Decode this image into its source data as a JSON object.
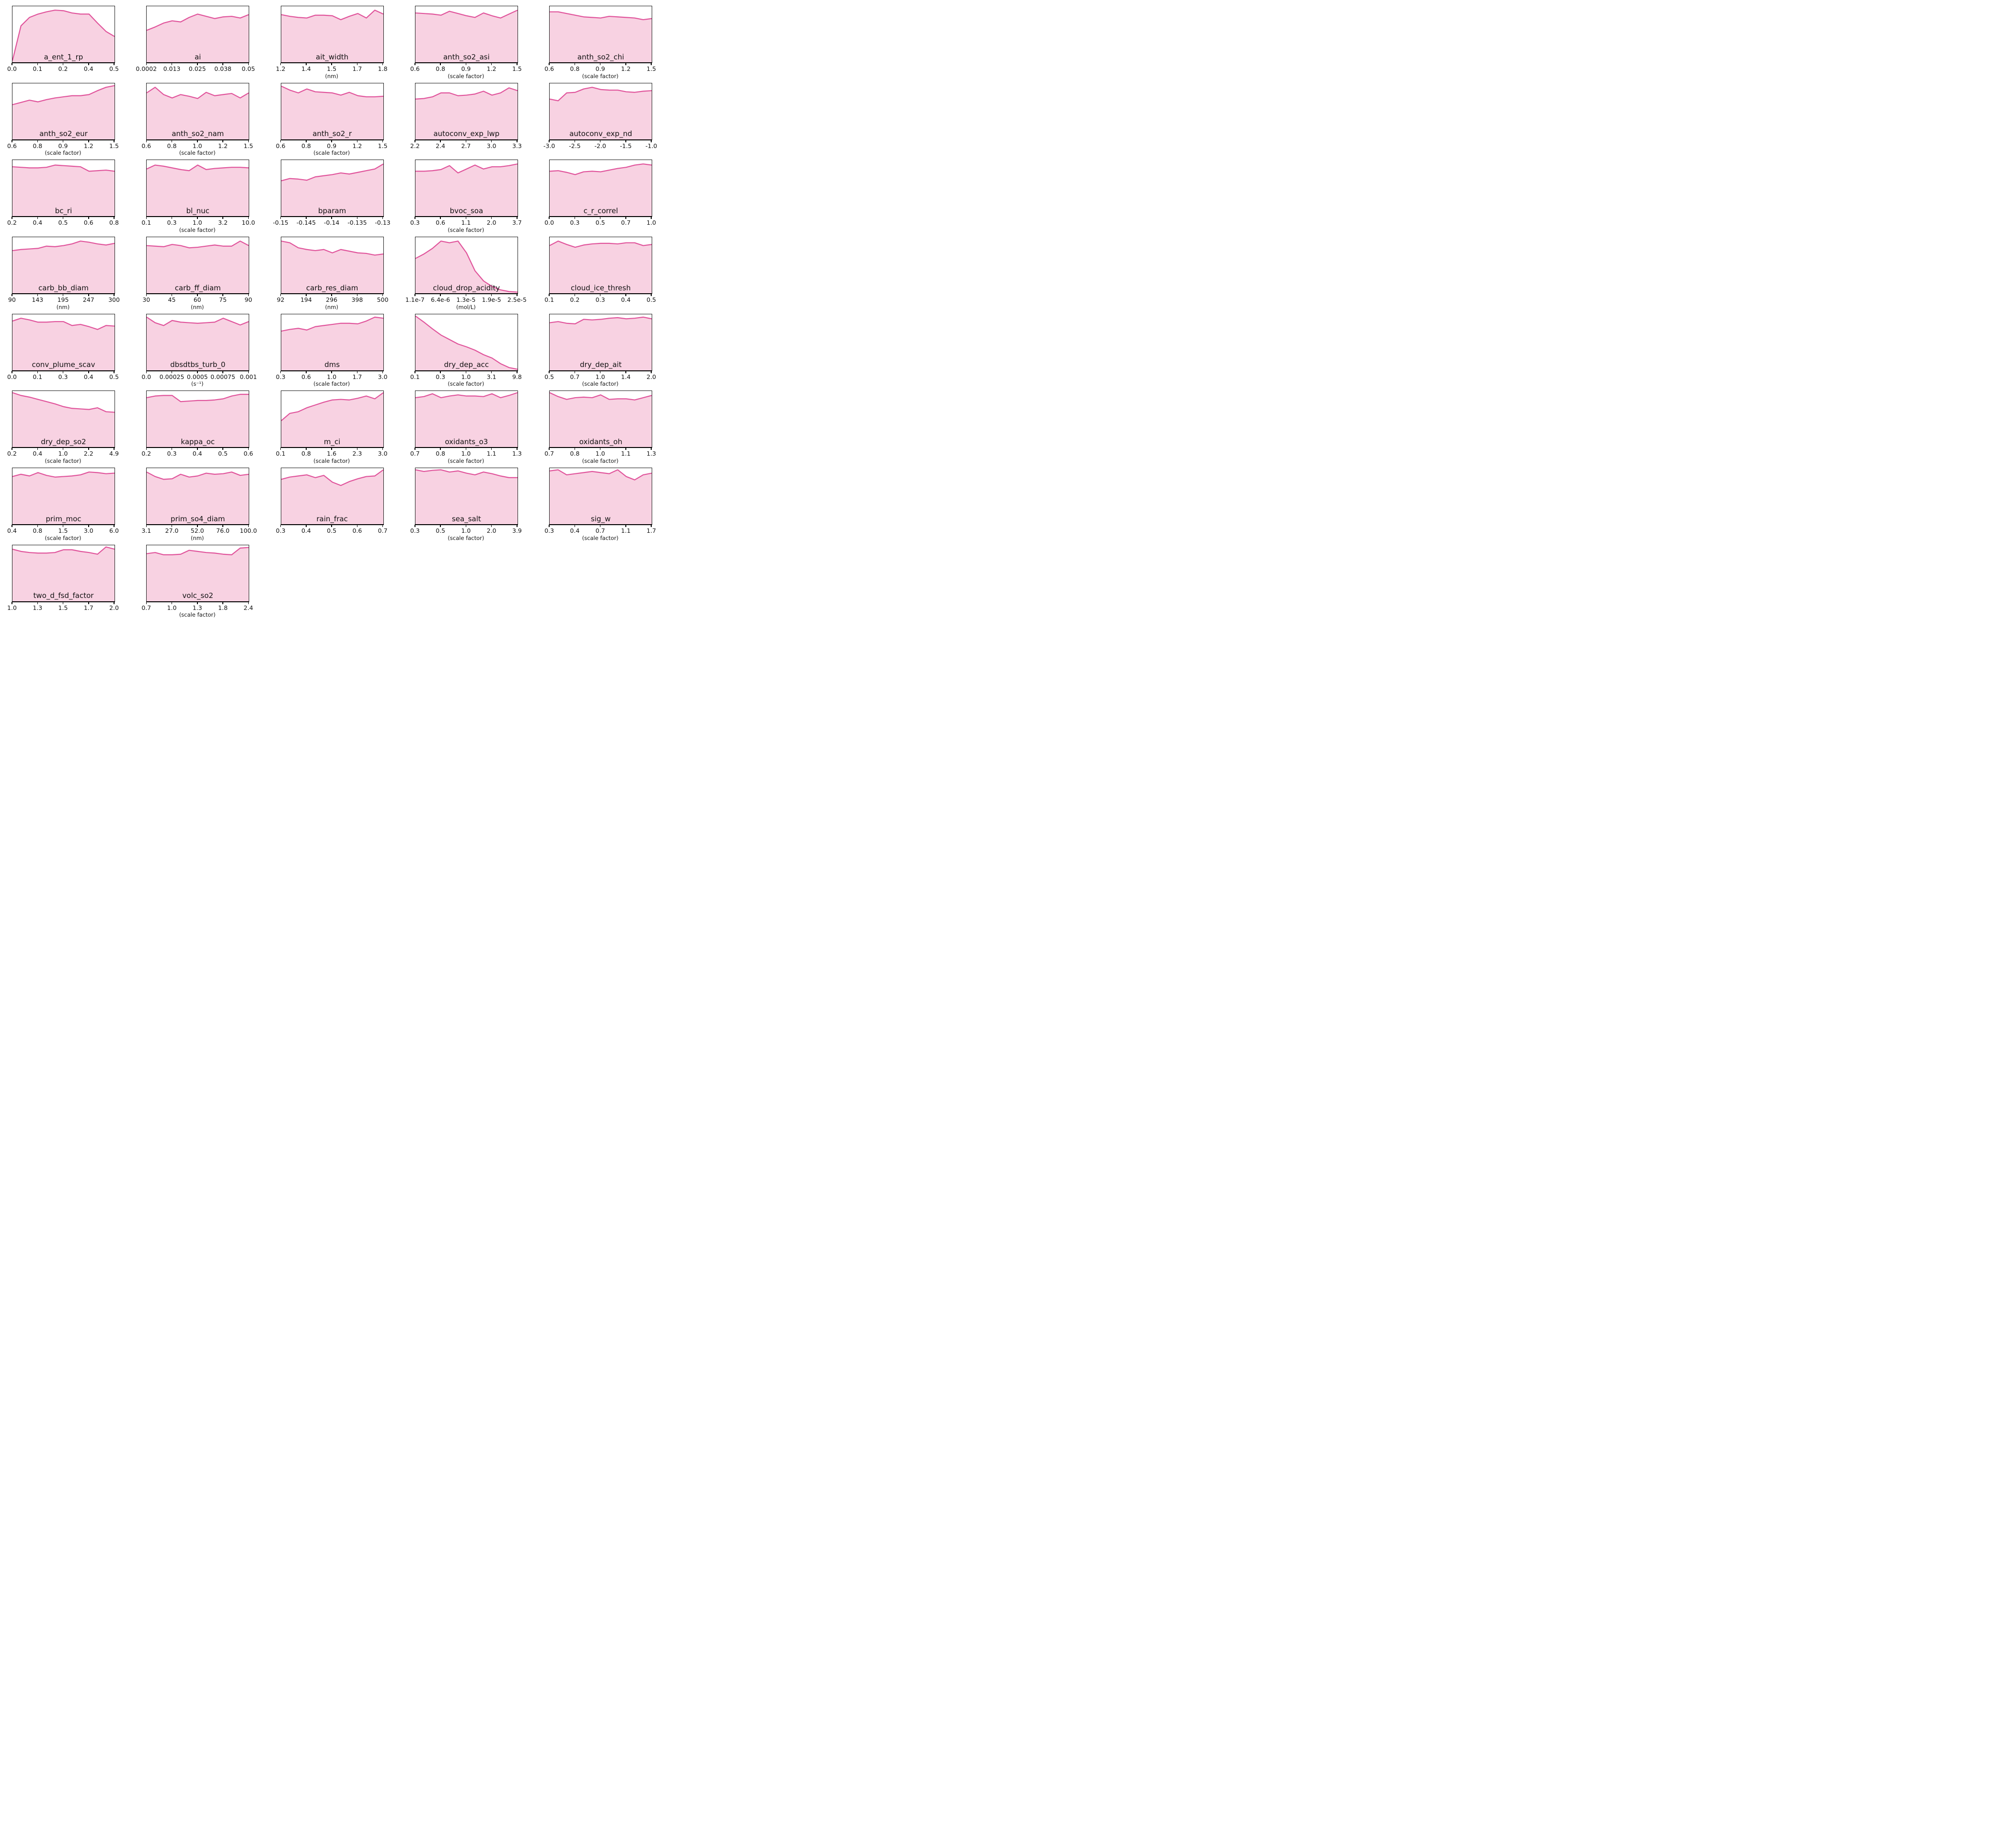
{
  "figure": {
    "background": "#ffffff",
    "line_color": "#e0549b",
    "fill_color": "#f8d2e2",
    "spine_color": "#1a1a1a",
    "columns": 5,
    "rows": 8
  },
  "chart_data": {
    "type": "area",
    "title": "",
    "ylabel": "",
    "grid": "off",
    "legend": "none",
    "y_values_note": "normalized marginal-density curve heights (0 = axis bottom, 1 = axes top), 13 evenly spaced samples across each x-range",
    "x_tick_positions_percent": [
      0,
      25,
      50,
      75,
      100
    ],
    "charts": [
      {
        "name": "a_ent_1_rp",
        "unit": "",
        "x_ticks": [
          "0.0",
          "0.1",
          "0.2",
          "0.4",
          "0.5"
        ],
        "y_norm": [
          0.03,
          0.65,
          0.8,
          0.86,
          0.9,
          0.93,
          0.92,
          0.88,
          0.86,
          0.86,
          0.7,
          0.55,
          0.46
        ]
      },
      {
        "name": "ai",
        "unit": "",
        "x_ticks": [
          "0.0002",
          "0.013",
          "0.025",
          "0.038",
          "0.05"
        ],
        "y_norm": [
          0.57,
          0.63,
          0.7,
          0.74,
          0.72,
          0.8,
          0.86,
          0.82,
          0.78,
          0.81,
          0.82,
          0.79,
          0.85
        ]
      },
      {
        "name": "ait_width",
        "unit": "(nm)",
        "x_ticks": [
          "1.2",
          "1.4",
          "1.5",
          "1.7",
          "1.8"
        ],
        "y_norm": [
          0.85,
          0.82,
          0.8,
          0.79,
          0.84,
          0.84,
          0.83,
          0.76,
          0.82,
          0.87,
          0.79,
          0.93,
          0.86
        ]
      },
      {
        "name": "anth_so2_asi",
        "unit": "(scale factor)",
        "x_ticks": [
          "0.6",
          "0.8",
          "0.9",
          "1.2",
          "1.5"
        ],
        "y_norm": [
          0.88,
          0.87,
          0.86,
          0.84,
          0.91,
          0.87,
          0.83,
          0.8,
          0.88,
          0.83,
          0.79,
          0.86,
          0.93
        ]
      },
      {
        "name": "anth_so2_chi",
        "unit": "(scale factor)",
        "x_ticks": [
          "0.6",
          "0.8",
          "0.9",
          "1.2",
          "1.5"
        ],
        "y_norm": [
          0.9,
          0.9,
          0.87,
          0.84,
          0.81,
          0.8,
          0.79,
          0.82,
          0.81,
          0.8,
          0.79,
          0.76,
          0.78
        ]
      },
      {
        "name": "anth_so2_eur",
        "unit": "(scale factor)",
        "x_ticks": [
          "0.6",
          "0.8",
          "0.9",
          "1.2",
          "1.5"
        ],
        "y_norm": [
          0.62,
          0.66,
          0.7,
          0.67,
          0.71,
          0.74,
          0.76,
          0.78,
          0.78,
          0.8,
          0.87,
          0.93,
          0.96
        ]
      },
      {
        "name": "anth_so2_nam",
        "unit": "(scale factor)",
        "x_ticks": [
          "0.6",
          "0.8",
          "1.0",
          "1.2",
          "1.5"
        ],
        "y_norm": [
          0.83,
          0.93,
          0.8,
          0.74,
          0.8,
          0.77,
          0.73,
          0.84,
          0.78,
          0.8,
          0.82,
          0.74,
          0.83
        ]
      },
      {
        "name": "anth_so2_r",
        "unit": "(scale factor)",
        "x_ticks": [
          "0.6",
          "0.8",
          "0.9",
          "1.2",
          "1.5"
        ],
        "y_norm": [
          0.95,
          0.88,
          0.83,
          0.9,
          0.85,
          0.84,
          0.83,
          0.79,
          0.84,
          0.78,
          0.76,
          0.76,
          0.77
        ]
      },
      {
        "name": "autoconv_exp_lwp",
        "unit": "",
        "x_ticks": [
          "2.2",
          "2.4",
          "2.7",
          "3.0",
          "3.3"
        ],
        "y_norm": [
          0.72,
          0.73,
          0.76,
          0.83,
          0.83,
          0.78,
          0.79,
          0.81,
          0.86,
          0.79,
          0.83,
          0.92,
          0.87
        ]
      },
      {
        "name": "autoconv_exp_nd",
        "unit": "",
        "x_ticks": [
          "-3.0",
          "-2.5",
          "-2.0",
          "-1.5",
          "-1.0"
        ],
        "y_norm": [
          0.72,
          0.69,
          0.83,
          0.84,
          0.9,
          0.93,
          0.89,
          0.88,
          0.88,
          0.85,
          0.84,
          0.86,
          0.87
        ]
      },
      {
        "name": "bc_ri",
        "unit": "",
        "x_ticks": [
          "0.2",
          "0.4",
          "0.5",
          "0.6",
          "0.8"
        ],
        "y_norm": [
          0.88,
          0.87,
          0.86,
          0.86,
          0.87,
          0.91,
          0.9,
          0.89,
          0.88,
          0.8,
          0.81,
          0.82,
          0.8
        ]
      },
      {
        "name": "bl_nuc",
        "unit": "(scale factor)",
        "x_ticks": [
          "0.1",
          "0.3",
          "1.0",
          "3.2",
          "10.0"
        ],
        "y_norm": [
          0.84,
          0.91,
          0.89,
          0.86,
          0.83,
          0.81,
          0.91,
          0.83,
          0.85,
          0.86,
          0.87,
          0.87,
          0.86
        ]
      },
      {
        "name": "bparam",
        "unit": "",
        "x_ticks": [
          "-0.15",
          "-0.145",
          "-0.14",
          "-0.135",
          "-0.13"
        ],
        "y_norm": [
          0.63,
          0.67,
          0.66,
          0.64,
          0.7,
          0.72,
          0.74,
          0.77,
          0.75,
          0.78,
          0.81,
          0.84,
          0.93
        ]
      },
      {
        "name": "bvoc_soa",
        "unit": "(scale factor)",
        "x_ticks": [
          "0.3",
          "0.6",
          "1.1",
          "2.0",
          "3.7"
        ],
        "y_norm": [
          0.8,
          0.8,
          0.81,
          0.83,
          0.9,
          0.77,
          0.84,
          0.91,
          0.84,
          0.88,
          0.88,
          0.9,
          0.93
        ]
      },
      {
        "name": "c_r_correl",
        "unit": "",
        "x_ticks": [
          "0.0",
          "0.3",
          "0.5",
          "0.7",
          "1.0"
        ],
        "y_norm": [
          0.8,
          0.81,
          0.78,
          0.74,
          0.79,
          0.8,
          0.79,
          0.82,
          0.85,
          0.87,
          0.91,
          0.93,
          0.91
        ]
      },
      {
        "name": "carb_bb_diam",
        "unit": "(nm)",
        "x_ticks": [
          "90",
          "143",
          "195",
          "247",
          "300"
        ],
        "y_norm": [
          0.76,
          0.78,
          0.79,
          0.8,
          0.84,
          0.83,
          0.85,
          0.88,
          0.93,
          0.91,
          0.88,
          0.86,
          0.89
        ]
      },
      {
        "name": "carb_ff_diam",
        "unit": "(nm)",
        "x_ticks": [
          "30",
          "45",
          "60",
          "75",
          "90"
        ],
        "y_norm": [
          0.85,
          0.84,
          0.83,
          0.87,
          0.85,
          0.81,
          0.82,
          0.84,
          0.86,
          0.84,
          0.84,
          0.93,
          0.85
        ]
      },
      {
        "name": "carb_res_diam",
        "unit": "(nm)",
        "x_ticks": [
          "92",
          "194",
          "296",
          "398",
          "500"
        ],
        "y_norm": [
          0.93,
          0.9,
          0.81,
          0.78,
          0.76,
          0.78,
          0.72,
          0.78,
          0.75,
          0.72,
          0.71,
          0.68,
          0.7
        ]
      },
      {
        "name": "cloud_drop_acidity",
        "unit": "(mol/L)",
        "x_ticks": [
          "1.1e-7",
          "6.4e-6",
          "1.3e-5",
          "1.9e-5",
          "2.5e-5"
        ],
        "y_norm": [
          0.62,
          0.7,
          0.8,
          0.93,
          0.9,
          0.93,
          0.72,
          0.4,
          0.22,
          0.12,
          0.06,
          0.03,
          0.02
        ]
      },
      {
        "name": "cloud_ice_thresh",
        "unit": "",
        "x_ticks": [
          "0.1",
          "0.2",
          "0.3",
          "0.4",
          "0.5"
        ],
        "y_norm": [
          0.85,
          0.93,
          0.87,
          0.82,
          0.86,
          0.88,
          0.89,
          0.89,
          0.88,
          0.9,
          0.9,
          0.85,
          0.87
        ]
      },
      {
        "name": "conv_plume_scav",
        "unit": "",
        "x_ticks": [
          "0.0",
          "0.1",
          "0.3",
          "0.4",
          "0.5"
        ],
        "y_norm": [
          0.88,
          0.93,
          0.9,
          0.86,
          0.86,
          0.87,
          0.87,
          0.8,
          0.82,
          0.78,
          0.73,
          0.8,
          0.79
        ]
      },
      {
        "name": "dbsdtbs_turb_0",
        "unit": "(s⁻¹)",
        "x_ticks": [
          "0.0",
          "0.00025",
          "0.0005",
          "0.00075",
          "0.001"
        ],
        "y_norm": [
          0.95,
          0.85,
          0.8,
          0.89,
          0.86,
          0.85,
          0.84,
          0.85,
          0.86,
          0.93,
          0.87,
          0.81,
          0.87
        ]
      },
      {
        "name": "dms",
        "unit": "(scale factor)",
        "x_ticks": [
          "0.3",
          "0.6",
          "1.0",
          "1.7",
          "3.0"
        ],
        "y_norm": [
          0.7,
          0.73,
          0.75,
          0.72,
          0.78,
          0.8,
          0.82,
          0.84,
          0.84,
          0.83,
          0.88,
          0.95,
          0.93
        ]
      },
      {
        "name": "dry_dep_acc",
        "unit": "(scale factor)",
        "x_ticks": [
          "0.1",
          "0.3",
          "1.0",
          "3.1",
          "9.8"
        ],
        "y_norm": [
          0.97,
          0.86,
          0.74,
          0.63,
          0.55,
          0.47,
          0.42,
          0.36,
          0.28,
          0.22,
          0.12,
          0.05,
          0.02
        ]
      },
      {
        "name": "dry_dep_ait",
        "unit": "(scale factor)",
        "x_ticks": [
          "0.5",
          "0.7",
          "1.0",
          "1.4",
          "2.0"
        ],
        "y_norm": [
          0.85,
          0.87,
          0.84,
          0.83,
          0.91,
          0.9,
          0.91,
          0.93,
          0.94,
          0.92,
          0.93,
          0.95,
          0.92
        ]
      },
      {
        "name": "dry_dep_so2",
        "unit": "(scale factor)",
        "x_ticks": [
          "0.2",
          "0.4",
          "1.0",
          "2.2",
          "4.9"
        ],
        "y_norm": [
          0.97,
          0.92,
          0.89,
          0.85,
          0.81,
          0.77,
          0.72,
          0.69,
          0.68,
          0.67,
          0.7,
          0.63,
          0.62
        ]
      },
      {
        "name": "kappa_oc",
        "unit": "",
        "x_ticks": [
          "0.2",
          "0.3",
          "0.4",
          "0.5",
          "0.6"
        ],
        "y_norm": [
          0.88,
          0.91,
          0.92,
          0.92,
          0.81,
          0.82,
          0.83,
          0.83,
          0.84,
          0.86,
          0.91,
          0.94,
          0.94
        ]
      },
      {
        "name": "m_ci",
        "unit": "(scale factor)",
        "x_ticks": [
          "0.1",
          "0.8",
          "1.6",
          "2.3",
          "3.0"
        ],
        "y_norm": [
          0.47,
          0.6,
          0.63,
          0.7,
          0.75,
          0.8,
          0.84,
          0.85,
          0.84,
          0.87,
          0.91,
          0.86,
          0.97
        ]
      },
      {
        "name": "oxidants_o3",
        "unit": "(scale factor)",
        "x_ticks": [
          "0.7",
          "0.8",
          "1.0",
          "1.1",
          "1.3"
        ],
        "y_norm": [
          0.88,
          0.9,
          0.95,
          0.88,
          0.91,
          0.93,
          0.91,
          0.91,
          0.9,
          0.95,
          0.88,
          0.92,
          0.97
        ]
      },
      {
        "name": "oxidants_oh",
        "unit": "(scale factor)",
        "x_ticks": [
          "0.7",
          "0.8",
          "1.0",
          "1.1",
          "1.3"
        ],
        "y_norm": [
          0.97,
          0.9,
          0.85,
          0.88,
          0.89,
          0.88,
          0.93,
          0.85,
          0.86,
          0.86,
          0.84,
          0.88,
          0.92
        ]
      },
      {
        "name": "prim_moc",
        "unit": "(scale factor)",
        "x_ticks": [
          "0.4",
          "0.8",
          "1.5",
          "3.0",
          "6.0"
        ],
        "y_norm": [
          0.85,
          0.89,
          0.86,
          0.92,
          0.87,
          0.84,
          0.85,
          0.86,
          0.88,
          0.93,
          0.92,
          0.9,
          0.91
        ]
      },
      {
        "name": "prim_so4_diam",
        "unit": "(nm)",
        "x_ticks": [
          "3.1",
          "27.0",
          "52.0",
          "76.0",
          "100.0"
        ],
        "y_norm": [
          0.93,
          0.85,
          0.8,
          0.81,
          0.89,
          0.84,
          0.86,
          0.91,
          0.89,
          0.9,
          0.93,
          0.87,
          0.89
        ]
      },
      {
        "name": "rain_frac",
        "unit": "",
        "x_ticks": [
          "0.3",
          "0.4",
          "0.5",
          "0.6",
          "0.7"
        ],
        "y_norm": [
          0.8,
          0.84,
          0.86,
          0.88,
          0.83,
          0.87,
          0.75,
          0.69,
          0.76,
          0.81,
          0.85,
          0.86,
          0.97
        ]
      },
      {
        "name": "sea_salt",
        "unit": "(scale factor)",
        "x_ticks": [
          "0.3",
          "0.5",
          "1.0",
          "2.0",
          "3.9"
        ],
        "y_norm": [
          0.97,
          0.94,
          0.96,
          0.97,
          0.93,
          0.95,
          0.91,
          0.88,
          0.93,
          0.9,
          0.86,
          0.83,
          0.83
        ]
      },
      {
        "name": "sig_w",
        "unit": "(scale factor)",
        "x_ticks": [
          "0.3",
          "0.4",
          "0.7",
          "1.1",
          "1.7"
        ],
        "y_norm": [
          0.95,
          0.97,
          0.88,
          0.9,
          0.92,
          0.94,
          0.92,
          0.9,
          0.97,
          0.85,
          0.79,
          0.88,
          0.91
        ]
      },
      {
        "name": "two_d_fsd_factor",
        "unit": "",
        "x_ticks": [
          "1.0",
          "1.3",
          "1.5",
          "1.7",
          "2.0"
        ],
        "y_norm": [
          0.93,
          0.89,
          0.87,
          0.86,
          0.86,
          0.87,
          0.92,
          0.92,
          0.89,
          0.87,
          0.84,
          0.97,
          0.93
        ]
      },
      {
        "name": "volc_so2",
        "unit": "(scale factor)",
        "x_ticks": [
          "0.7",
          "1.0",
          "1.3",
          "1.8",
          "2.4"
        ],
        "y_norm": [
          0.85,
          0.87,
          0.83,
          0.83,
          0.84,
          0.91,
          0.89,
          0.87,
          0.86,
          0.84,
          0.83,
          0.95,
          0.96
        ]
      }
    ]
  }
}
